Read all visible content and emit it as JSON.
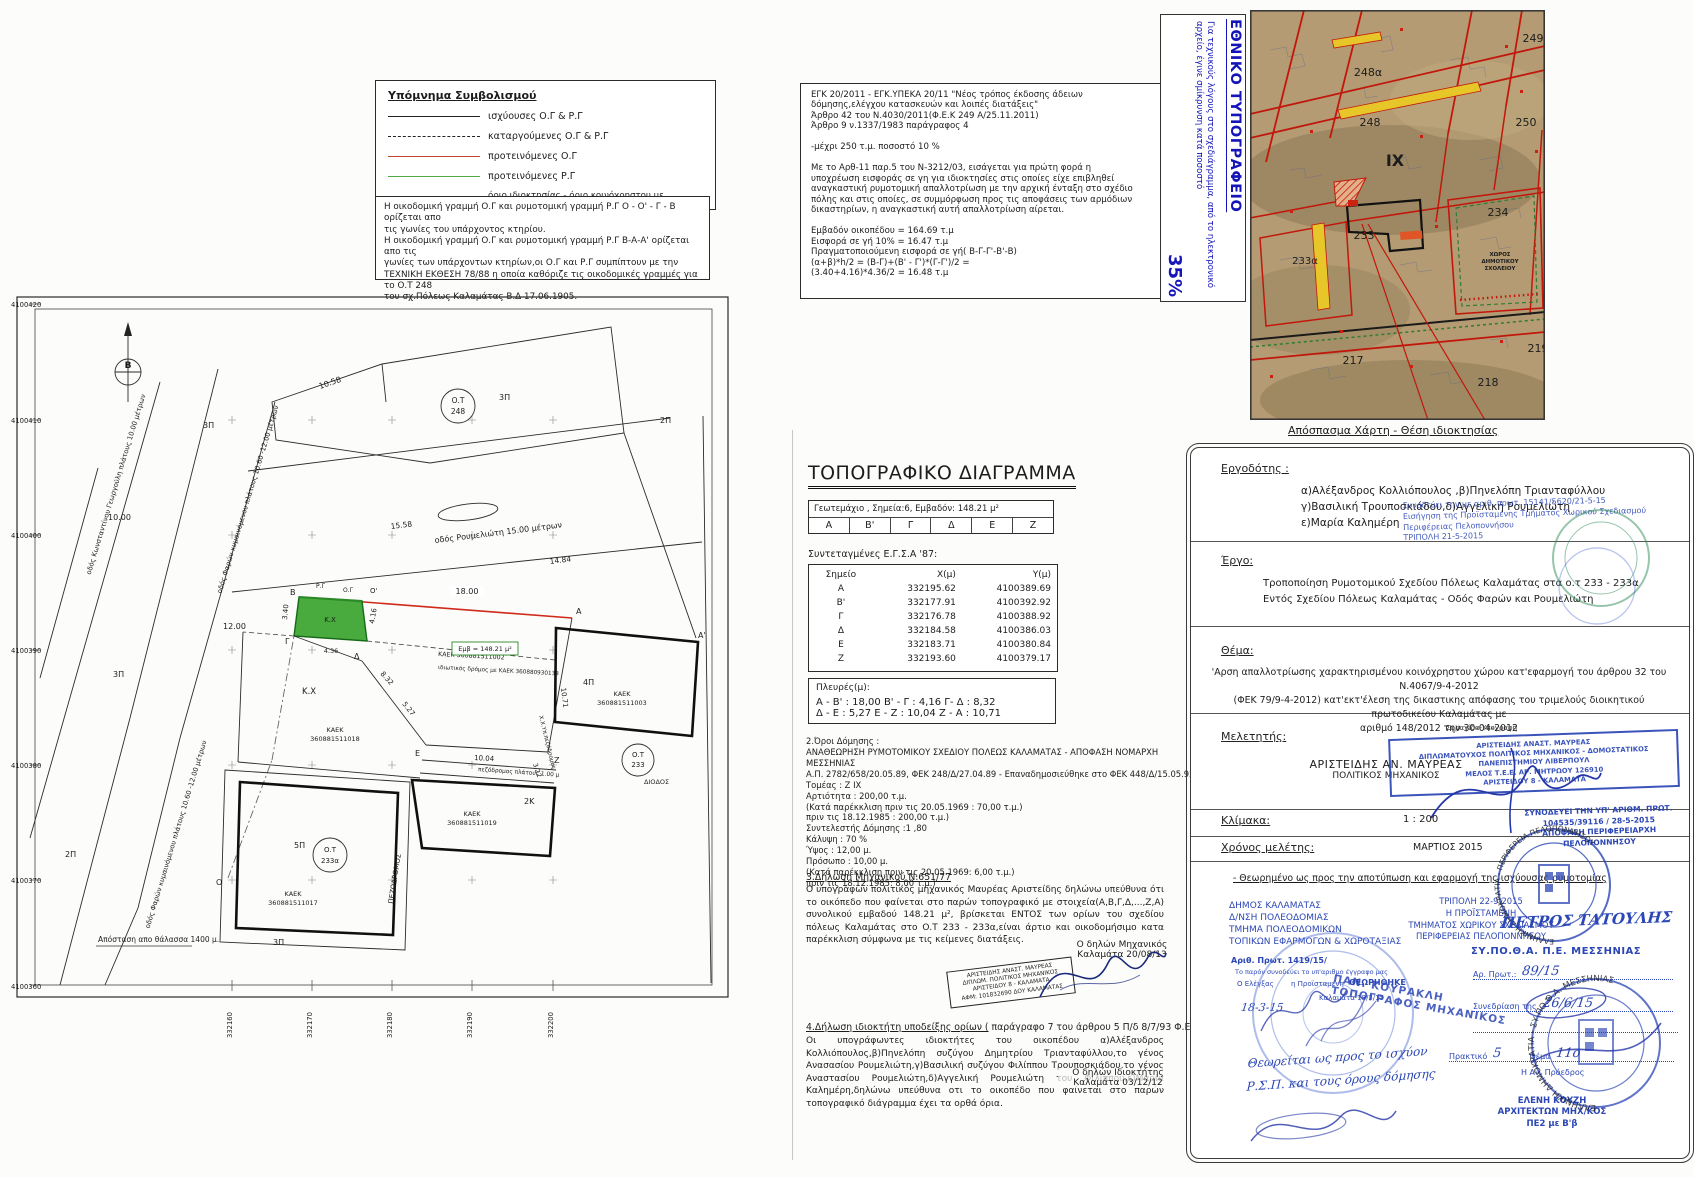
{
  "legend": {
    "title": "Υπόμνημα Συμβολισμού",
    "items": [
      {
        "label": "ισχύουσες Ο.Γ & Ρ.Γ"
      },
      {
        "label": "καταργούμενες Ο.Γ & Ρ.Γ"
      },
      {
        "label": "προτεινόμενες Ο.Γ"
      },
      {
        "label": "προτεινόμενες Ρ.Γ"
      },
      {
        "label": "όριο ιδιοκτησίας - όριο κοινόχρηστου  με οικοδομήσιμο χώρο"
      }
    ]
  },
  "notes_box": {
    "text": "Η οικοδομική γραμμή Ο.Γ και ρυμοτομική γραμμή Ρ.Γ  Ο - Ο' - Γ - Β ορίζεται απο\nτις γωνίες του υπάρχοντος κτηρίου.\nΗ οικοδομική γραμμή Ο.Γ και ρυμοτομική γραμμή Ρ.Γ Β-Α-Α' ορίζεται απο τις\nγωνίες των υπάρχοντων κτηρίων,οι Ο.Γ και Ρ.Γ συμπίπτουν με την\nΤΕΧΝΙΚΗ ΕΚΘΕΣΗ 78/88 η οποία καθόριζε τις οικοδομικές γραμμές για το Ο.Τ 248\nτου σχ.Πόλεως Καλαμάτας Β.Δ 17.06.1905."
  },
  "regulation_box": {
    "text": "ΕΓΚ 20/2011 - ΕΓΚ.ΥΠΕΚΑ 20/11 \"Νέος τρόπος έκδοσης άδειων\nδόμησης,ελέγχου κατασκευών και λοιπές διατάξεις\"\nΆρθρο 42 του Ν.4030/2011(Φ.Ε.Κ 249 Α/25.11.2011)\nΆρθρο 9 ν.1337/1983 παράγραφος 4\n\n-μέχρι 250 τ.μ. ποσοστό 10 %\n\n Με το Αρθ-11 παρ.5 του Ν-3212/03, εισάγεται για πρώτη φορά η\nυποχρέωση εισφοράς σε γη για ιδιοκτησίες στις οποίες είχε επιβληθεί\nαναγκαστική ρυμοτομική απαλλοτρίωση με την αρχική ένταξη στο σχέδιο\nπόλης και στις οποίες, σε συμμόρφωση προς τις αποφάσεις των αρμόδιων\nδικαστηρίων, η αναγκαστική αυτή απαλλοτρίωση αίρεται.\n\nΕμβαδόν οικοπέδου = 164.69 τ.μ\nΕισφορά σε γή 10% = 16.47 τ.μ\nΠραγματοποιούμενη εισφορά σε γή( Β-Γ-Γ'-Β'-Β)\n(α+β)*h/2 = (Β-Γ)+(Β' - Γ')*(Γ-Γ')/2 =\n(3.40+4.16)*4.36/2 = 16.48 τ.μ"
  },
  "print_note": {
    "title": "ΕΘΝΙΚΟ ΤΥΠΟΓΡΑΦΕΙΟ",
    "body": "Για τεχνικούς λόγους στο σχεδιάγραμμα, από το ηλεκτρονικό αρχείο, έγινε σμίκρυνση κατά ποσοστό",
    "percent": "35%"
  },
  "map": {
    "caption": "Απόσπασμα Χάρτη - Θέση ιδιοκτησίας",
    "labels": {
      "b249": "249",
      "b248a": "248α",
      "b248": "248",
      "b250": "250",
      "b234": "234",
      "b233": "233",
      "b233a": "233α",
      "b217": "217",
      "b218": "218",
      "b219": "219",
      "ix": "ΙΧ",
      "school1": "ΧΩΡΟΣ",
      "school2": "ΔΗΜΟΤΙΚΟΥ",
      "school3": "ΣΧΟΛΕΙΟΥ"
    }
  },
  "plan": {
    "north": "Β",
    "axis_y": [
      "4100420",
      "4100410",
      "4100400",
      "4100390",
      "4100380",
      "4100370",
      "4100360"
    ],
    "axis_x": [
      "332160",
      "332170",
      "332180",
      "332190",
      "332200"
    ],
    "ot": "Ο.Τ",
    "b248": "248",
    "b233": "233",
    "b233a": "233α",
    "streets": {
      "georgouli": "οδός Κωνσταντίνου Γεωργούλη πλάτους 10.00 μέτρων",
      "faron": "οδός Φαρών κυμαινόμενου πλάτους 10.60 -12.00 μέτρων",
      "roumelioti": "οδός Ρουμελιώτη 15.00 μέτρων",
      "private_road": "ιδιωτικός δρόμος με ΚΑΕΚ 360880930133",
      "pez_small": "πεζόδρομος πλάτους 1.00 μ",
      "pez_big": "ΠΕΖΟΔΡΟΜΟΣ",
      "xxyp": "Χ.Χ.Υπ.πεζόδρομος"
    },
    "dims": {
      "d1058": "10.58",
      "d1558": "15.58",
      "d1484": "14.84",
      "d1200": "12.00",
      "d1000": "10.00",
      "d1800": "18.00",
      "d832": "8.32",
      "d527": "5.27",
      "d1004": "10.04",
      "d1071": "10.71",
      "d322": "3.22",
      "d340": "3.40",
      "d416": "4.16",
      "d436": "4.36"
    },
    "kaek_word": "ΚΑΕΚ",
    "kaek": {
      "k002": "ΚΑΕΚ 360881511002",
      "k003": "360881511003",
      "k018": "360881511018",
      "k019": "360881511019",
      "k017": "360881511017"
    },
    "floors": {
      "p3": "3Π",
      "p2": "2Π",
      "p5": "5Π",
      "p4": "4Π",
      "k2": "2Κ"
    },
    "points": {
      "A": "Α",
      "A1": "Α'",
      "B": "Β",
      "G": "Γ",
      "D": "Δ",
      "E": "Ε",
      "Z": "Ζ",
      "O": "Ο",
      "O1": "Ο'",
      "RG": "Ρ.Γ",
      "OG": "Ο.Γ"
    },
    "kx": "Κ.Χ",
    "emb": "Εμβ = 148.21 μ²",
    "diodos": "ΔΙΟΔΟΣ",
    "sea": "Απόσταση απο θάλασσα 1400 μ."
  },
  "topo": {
    "title": "ΤΟΠΟΓΡΑΦΙΚΟ ΔΙΑΓΡΑΜΜΑ",
    "parcel_info": "Γεωτεμάχιο  ,  Σημεία:6,  Εμβαδόν: 148.21 μ²",
    "cells": [
      "Α",
      "Β'",
      "Γ",
      "Δ",
      "Ε",
      "Ζ"
    ],
    "coords_heading": "Συντεταγμένες Ε.Γ.Σ.Α '87:",
    "col_point": "Σημείο",
    "col_x": "Χ(μ)",
    "col_y": "Υ(μ)",
    "rows": [
      [
        "Α",
        "332195.62",
        "4100389.69"
      ],
      [
        "Β'",
        "332177.91",
        "4100392.92"
      ],
      [
        "Γ",
        "332176.78",
        "4100388.92"
      ],
      [
        "Δ",
        "332184.58",
        "4100386.03"
      ],
      [
        "Ε",
        "332183.71",
        "4100380.84"
      ],
      [
        "Ζ",
        "332193.60",
        "4100379.17"
      ]
    ],
    "sides_title": "Πλευρές(μ):",
    "sides1": "Α - Β' : 18,00  Β' - Γ : 4,16  Γ- Δ : 8,32",
    "sides2": "Δ - Ε : 5,27  Ε - Ζ : 10,04  Ζ - Α : 10,71",
    "terms": "2.Όροι Δόμησης :\nΑΝΑΘΕΩΡΗΣΗ ΡΥΜΟΤΟΜΙΚΟΥ ΣΧΕΔΙΟΥ  ΠΟΛΕΩΣ ΚΑΛΑΜΑΤΑΣ  -  ΑΠΟΦΑΣΗ ΝΟΜΑΡΧΗ ΜΕΣΣΗΝΙΑΣ\nΑ.Π. 2782/658/20.05.89, ΦΕΚ  248/Δ/27.04.89 - Επαναδημοσιεύθηκε στο ΦΕΚ 448/Δ/15.05.92\nΤομέας    : Ζ ΙΧ\nΑρτιότητα : 200,00 τ.μ.\n(Κατά παρέκκλιση   πριν τις  20.05.1969 : 70,00  τ.μ.)\n                  πριν τις  18.12.1985 : 200,00  τ.μ.)\nΣυντελεστής Δόμησης  :1 ,80\nΚάλυψη : 70 %\nΎψος : 12,00 μ.\nΠρόσωπο  : 10,00 μ.\n(Κατά παρέκκλιση πριν τις   20.05.1969: 6,00 τ.μ.)\n                  πριν τις  18.12.1985: 8,00 τ.μ.)",
    "decl3_h": "3.Δήλωση Μηχανικού Ν.651/77",
    "decl3": "Ο υπογράφων πολιτικός μηχανικός Μαυρέας Αριστείδης δηλώνω υπεύθυνα ότι το οικόπεδο που φαίνεται στο παρών τοπογραφικό με στοιχεία(Α,Β,Γ,Δ,...,Ζ,Α) συνολικού εμβαδού 148.21 μ², βρίσκεται ΕΝΤΟΣ των ορίων του σχεδίου πόλεως Καλαμάτας στο Ο.Τ 233 - 233α,είναι άρτιο και οικοδομήσιμο κατα παρέκκλιση σύμφωνα με τις κείμενες διατάξεις.",
    "decl3_sign1": "Ο δηλών Μηχανικός",
    "decl3_sign2": "Καλαμάτα 20/08/13",
    "eng_stamp": "ΑΡΙΣΤΕΙΔΗΣ ΑΝΑΣΤ. ΜΑΥΡΕΑΣ\nΔΙΠΛΩΜ. ΠΟΛΙΤΙΚΟΣ ΜΗΧΑΝΙΚΟΣ\nΑΡΙΣΤΕΙΔΟΥ 8 - ΚΑΛΑΜΑΤΑ\nΑΦΜ: 101832690 ΔΟΥ ΚΑΛΑΜΑΤΑΣ",
    "decl4_h1": "4.Δήλωση ιδιοκτήτη  υποδείξης ορίων (",
    "decl4_h2": " παράγραφο 7 του άρθρου 5 Π/δ 8/7/93 Φ.Ε.Κ 7958/13-7-93 )",
    "decl4": "Οι υπογράφωντες ιδιοκτήτες του οικοπέδου α)Αλέξανδρος Κολλιόπουλος,β)Πηνελόπη συζύγου Δημητρίου Τριανταφύλλου,το γένος Ανασασίου Ρουμελιώτη,γ)Βασιλική συζύγου Φιλίππου Τρουποσκιάδου,το γένος Αναστασίου Ρουμελιώτη,δ)Αγγελική Ρουμελιώτη του Φιλίππου,ε)Μαρία Καλημέρη,δηλώνω υπεύθυνα οτι το οικοπέδο που φαίνεται στο παρών τοπογραφικό διάγραμμα έχει τα ορθά όρια.",
    "decl4_sign1": "Ο δηλών Ιδιοκτήτης",
    "decl4_sign2": "Καλαμάτα 03/12/12"
  },
  "form": {
    "ergodotis_label": "Εργοδότης :",
    "ergodotis": "α)Αλέξανδρος Κολλιόπουλος ,β)Πηνελόπη Τριανταφύλλου\nγ)Βασιλική Τρουποσκιάδου,δ)Αγγελική Ρουμελιώτη\nε)Μαρία Καλημέρη",
    "note1": "Συνοδεύει την με αριθ. πρωτ. 15141/5620/21-5-15\nΕισήγηση της Προϊσταμένης Τμήματος Χωρικού Σχεδιασμού\nΠεριφέρειας Πελοποννήσου\nΤΡΙΠΟΛΗ 21-5-2015",
    "ergo_label": "Έργο:",
    "ergo": "Τροποποίηση Ρυμοτομικού Σχεδίου Πόλεως Καλαμάτας στα ο.τ 233 - 233α\nΕντός Σχεδίου Πόλεως Καλαμάτας - Οδός  Φαρών και Ρουμελιώτη",
    "thema_label": "Θέμα:",
    "thema": "'Αρση απαλλοτρίωσης χαρακτηρισμένου κοινόχρηστου χώρου  κατ'εφαρμογή του άρθρου 32 του Ν.4067/9-4-2012\n(ΦΕΚ 79/9-4-2012) κατ'εκτ'έλεση της δικαστικης απόφασης του τριμελούς διοικητικού πρωτοδικείου Καλαμάτας με\nαριθμό 148/2012 την 30-04-2012",
    "meletitis_label": "Μελετητής:",
    "meletitis1": "ΑΡΙΣΤΕΙΔΗΣ  ΑΝ. ΜΑΥΡΕΑΣ",
    "meletitis2": "ΠΟΛΙΤΙΚΟΣ ΜΗΧΑΝΙΚΟΣ",
    "sfragida_label": "Σφραγίδα-Υπογραφή",
    "eng_stamp": "ΑΡΙΣΤΕΙΔΗΣ ΑΝΑΣΤ. ΜΑΥΡΕΑΣ\nΔΙΠΛΩΜΑΤΟΥΧΟΣ ΠΟΛΙΤΙΚΟΣ ΜΗΧΑΝΙΚΟΣ - ΔΟΜΟΣΤΑΤΙΚΟΣ\nΠΑΝΕΠΙΣΤΗΜΙΟΥ ΛΙΒΕΡΠΟΥΛ\nΜΕΛΟΣ Τ.Ε.Ε. ΑΡ. ΜΗΤΡΩΟΥ 126910\nΑΡΙΣΤΕΙΔΟΥ 8 - ΚΑΛΑΜΑΤΑ",
    "klimaka_label": "Κλίμακα:",
    "klimaka": "1 : 200",
    "xronos_label": "Χρόνος μελέτης:",
    "xronos": "ΜΑΡΤΙΟΣ 2015",
    "note2": "ΣΥΝΟΔΕΥΕΙ ΤΗΝ ΥΠ' ΑΡΙΘΜ. ΠΡΩΤ.\n104535/39116 / 28-5-2015\nΑΠΟΦΑΣΗ ΠΕΡΙΦΕΡΕΙΑΡΧΗ ΠΕΛΟΠΟΝΝΗΣΟΥ",
    "theorimeno": "- Θεωρημένο ως προς την αποτύπωση και εφαρμογή της ισχύουσας ρυμοτομίας",
    "dimos_stamp": "ΔΗΜΟΣ ΚΑΛΑΜΑΤΑΣ\nΔ/ΝΣΗ ΠΟΛΕΟΔΟΜΙΑΣ\nΤΜΗΜΑ ΠΟΛΕΟΔΟΜΙΚΩΝ\nΤΟΠΙΚΩΝ ΕΦΑΡΜΟΓΩΝ & ΧΩΡΟΤΑΞΙΑΣ",
    "arith_prot": "Αριθ. Πρωτ. 1419/15/",
    "synodeuei_small": "Το παρόν συνοδεύει το υπ'αριθμο έγγραφο μας",
    "elegxas": "Ο Ελέγξας",
    "proistameni": "η Προϊσταμένη",
    "theorithike": "ΘΕΩΡΗΘΗΚΕ",
    "date1": "18-3-15",
    "kalamata_date": "Καλαμάτα 18/3/15",
    "tripoli_stamp": "ΤΡΙΠΟΛΗ 22-9-2015\nΗ ΠΡΟΪΣΤΑΜΕΝΗ\nΤΜΗΜΑΤΟΣ ΧΩΡΙΚΟΥ ΣΧΕΔΙΑΣΜΟΥ\nΠΕΡΙΦΕΡΕΙΑΣ ΠΕΛΟΠΟΝΝΗΣΟΥ",
    "petros": "ΠΕΤΡΟΣ ΤΑΤΟΥΛΗΣ",
    "sypotha": "ΣΥ.ΠΟ.Θ.Α.   Π.Ε. ΜΕΣΣΗΝΙΑΣ",
    "ar_prot_label": "Αρ. Πρωτ.:",
    "ar_prot": "89/15",
    "synedriasi_label": "Συνεδρίαση της",
    "synedriasi": "26/6/15",
    "praktiko_label": "Πρακτικό",
    "praktiko": "5",
    "thema2_label": "Θέμα",
    "thema2": "11ο",
    "an_proedros": "Η Αν. Πρόεδρος",
    "eleni": "ΕΛΕΝΗ ΚΟΥΖΗ\nΑΡΧΙΤΕΚΤΩΝ ΜΗΧ/ΚΟΣ\nΠΕ2 με Β'β",
    "kourakli": "ΠΑΝ. ΚΟΥΡΑΚΛΗ\nΤΟΠΟΓΡΑΦΟΣ ΜΗΧΑΝΙΚΟΣ",
    "handwritten": "Θεωρείται ως προς το ισχύον\nΡ.Σ.Π. και τους όρους δόμησης",
    "stamp_arc1": "ΕΛΛΗΝΙΚΗ ΔΗΜΟΚΡΑΤΙΑ - ΠΕΡΙΦΕΡΕΙΑ ΠΕΛΟΠΟΝΝΗΣΟΥ",
    "stamp_arc2": "ΕΛΛΗΝΙΚΗ ΔΗΜΟΚΡΑΤΙΑ - ΣΥ.ΠΟ.Θ.Α. ΜΕΣΣΗΝΙΑΣ"
  }
}
